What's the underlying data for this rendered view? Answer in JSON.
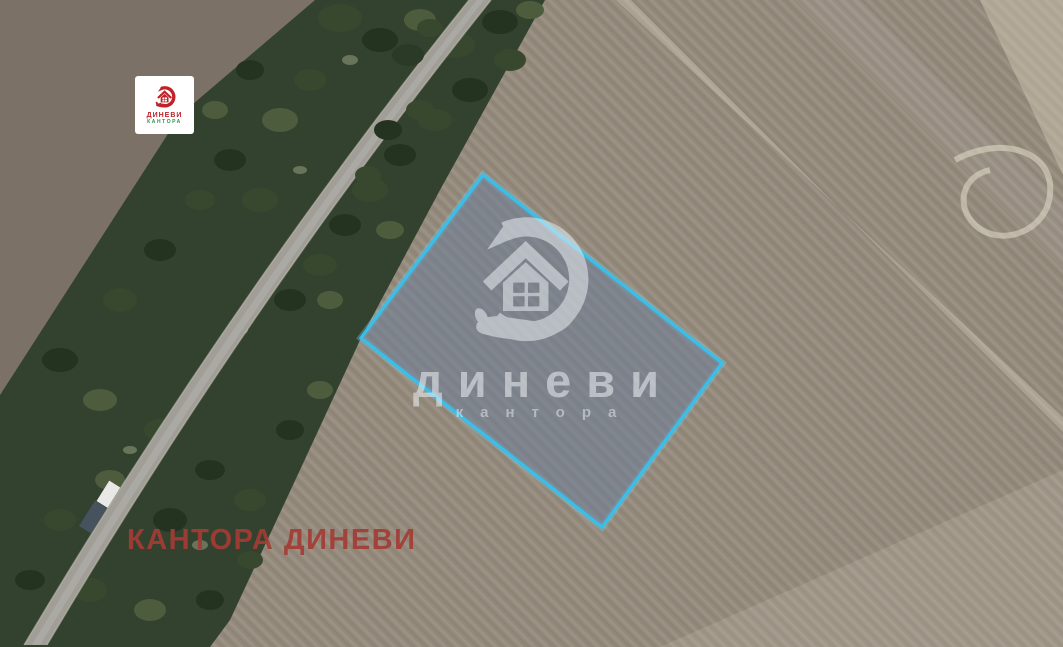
{
  "watermark": {
    "brand": "диневи",
    "subtitle": "кантора",
    "icon": "house-in-hand-logo",
    "color": "#eef2f6"
  },
  "caption": {
    "text": "КАНТОРА ДИНЕВИ",
    "color": "#a43b35"
  },
  "corner_logo": {
    "brand": "ДИНЕВИ",
    "subtitle": "КАНТОРА",
    "icon": "house-in-hand-logo",
    "brand_color": "#bf2228",
    "subtitle_color": "#2f8f3a"
  },
  "parcel": {
    "points": "483,175 722,363 602,527 361,338",
    "outline_color": "#35c1ec",
    "glow_color": "rgba(110,210,240,0.35)",
    "fill": "rgba(104,124,155,0.5)"
  },
  "map_colors": {
    "field": "#93897b",
    "field_dark": "#82786c",
    "trees": "#33422e",
    "road": "#a09e97"
  }
}
